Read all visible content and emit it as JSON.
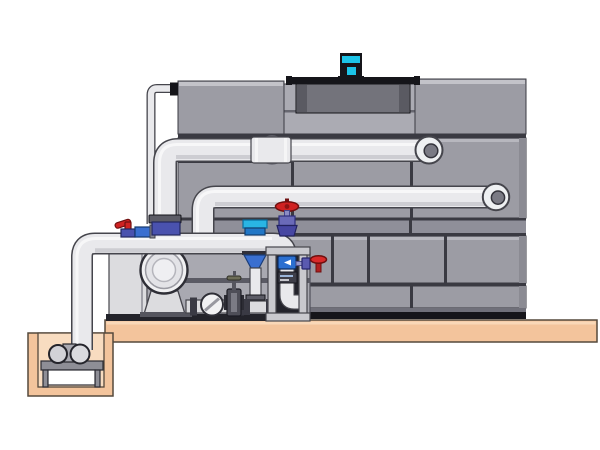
{
  "title": "Technical illustration of a cooling tower with condenser water pump skid, suction frame, sump pit pump and interconnecting piping on a concrete slab",
  "palette": {
    "bg": "#ffffff",
    "panel": "#9c9ca4",
    "panelTop": "#c3c3c9",
    "panelEdge": "#8b8b93",
    "seam": "#3a3a42",
    "recess": "#ababb3",
    "band": "#8f8f99",
    "shroud": "#73737b",
    "shroudShade": "#5a5a62",
    "black": "#15151a",
    "motorCyan": "#1cc4e8",
    "pipe": "#e9e9ec",
    "pipeShade": "#c3c3c9",
    "pipeStroke": "#45454c",
    "pipeOpening": "#7a7a84",
    "portal": "#c6c6cc",
    "slab": "#f3c49c",
    "slabHi": "#f9d8b8",
    "pitInner": "#f8dcc0",
    "ground": "#55493c",
    "equipLight": "#dcdcdf",
    "skid": "#a9a9b1",
    "rail": "#5a5a64",
    "frameLight": "#c9c9ce",
    "frameDark": "#23232b",
    "red": "#d02222",
    "redDark": "#701010",
    "valveBlue": "#4a52ae",
    "valveBlueLight": "#6a6ab8",
    "fittingBlue": "#3a6fd0",
    "skyBlue": "#2b6fd0",
    "cyanCap": "#29b5e4",
    "cyanDeep": "#2277c6",
    "labelBox": "#3e3e48",
    "flange": "#5c5c66",
    "darkFlange": "#3a3a44"
  },
  "components": [
    {
      "id": "cooling-tower",
      "label": "cooling tower casing with staggered panels"
    },
    {
      "id": "fan-shroud",
      "label": "fan shroud cylinder on tower deck"
    },
    {
      "id": "fan-motor",
      "label": "cyan fan motor"
    },
    {
      "id": "upper-supply-pipe",
      "label": "upper horizontal pipe with riser and end elbow"
    },
    {
      "id": "middle-return-pipe",
      "label": "middle horizontal pipe with riser and end elbow"
    },
    {
      "id": "equalizer-thin-pipe",
      "label": "thin equalizer pipe to tower top"
    },
    {
      "id": "main-suction-pipe",
      "label": "lower main pipe from sump pit to suction frame"
    },
    {
      "id": "end-suction-pump",
      "label": "end suction pump with circular inlet"
    },
    {
      "id": "valve-cluster",
      "label": "ball valve with red lever and blue fittings"
    },
    {
      "id": "suction-diffuser",
      "label": "cyan-capped suction diffuser with blue cone"
    },
    {
      "id": "check-valve",
      "label": "wafer check valve"
    },
    {
      "id": "gate-valve",
      "label": "gate valve with top tap"
    },
    {
      "id": "pipe-frame",
      "label": "support frame with gauge icon and internal elbow"
    },
    {
      "id": "globe-valve",
      "label": "globe valve with red handwheel"
    },
    {
      "id": "side-valve",
      "label": "side valve with red handwheel"
    },
    {
      "id": "concrete-slab",
      "label": "concrete slab"
    },
    {
      "id": "sump-pit",
      "label": "sump pit with small pump on stand"
    }
  ]
}
